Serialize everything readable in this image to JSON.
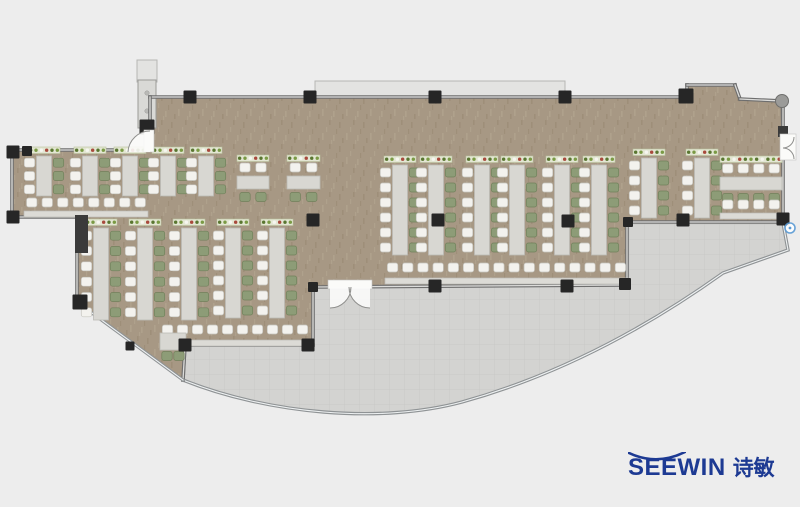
{
  "logo": {
    "latin": "SEEWIN",
    "cjk": "诗敏"
  },
  "palette": {
    "bg": "#ededed",
    "floor": "#a79884",
    "grain1": "#96876f",
    "grain2": "#b6a792",
    "terrace": "#d3d3d1",
    "terraceLine": "#c7c7c5",
    "wallDark": "#6e6e6e",
    "wallLight": "#dcdcda",
    "glass": "#8f9395",
    "glassLight": "#eef1f2",
    "column": "#262626",
    "block": "#3a3a3a",
    "table": "#d8d7d2",
    "tableBorder": "#bcbbb6",
    "chairWhite": "#f3f2ee",
    "chairWhiteBorder": "#c6c5bf",
    "chairGreen": "#8d9c77",
    "chairGreenBorder": "#71805b",
    "planter": "#e3e6d3",
    "planterBorder": "#b9c19c",
    "dotGreen": "#597630",
    "dotGreen2": "#7a9a44",
    "dotRed": "#a8493c",
    "dotWhite": "#f6f6f0",
    "counter": "#dcdbd6",
    "counterBorder": "#bdbcb7",
    "canopy": "#e3e3e1",
    "canopyBorder": "#b6b6b4",
    "shaft": "#d9d9d6",
    "shaftBorder": "#9a9a97",
    "shaftKnob": "#b9b9b6",
    "doorWhite": "#fbfbf9",
    "doorArc": "#8f8f8d",
    "markerBlue": "#5b9bd5",
    "logoBlue": "#1d3a93"
  },
  "plan": {
    "floor_outline": "150,97 687,97 687,85 735,85 740,99 781,101 783,222 627,222 627,285 313,287 313,345 185,345 183,380 77,302 77,217 12,217 12,150 150,150",
    "terrace_path": "M185,346 L313,346 L313,288 L627,286 L627,223 L783,223 L788,250 L723,273 C660,318 570,372 462,402 C380,424 268,414 183,380 Z",
    "terrace_glass": "M783,223 L788,250 L723,273 C660,318 570,372 462,402 C380,424 268,414 183,380 L185,345",
    "glass_walls": [
      [
        77,
        302,
        183,
        380
      ]
    ],
    "walls": [
      [
        150,
        97,
        687,
        97
      ],
      [
        687,
        97,
        687,
        85
      ],
      [
        687,
        85,
        735,
        85
      ],
      [
        735,
        85,
        740,
        99
      ],
      [
        740,
        99,
        781,
        101
      ],
      [
        783,
        101,
        783,
        222
      ],
      [
        627,
        222,
        783,
        222
      ],
      [
        627,
        222,
        627,
        285
      ],
      [
        313,
        287,
        627,
        285
      ],
      [
        313,
        287,
        313,
        345
      ],
      [
        185,
        345,
        313,
        345
      ],
      [
        183,
        380,
        185,
        345
      ],
      [
        77,
        302,
        77,
        217
      ],
      [
        12,
        217,
        77,
        217
      ],
      [
        12,
        150,
        12,
        217
      ],
      [
        12,
        150,
        150,
        150
      ],
      [
        150,
        97,
        150,
        150
      ]
    ],
    "canopies": [
      [
        315,
        81,
        250,
        16
      ],
      [
        137,
        60,
        20,
        22
      ]
    ],
    "shaft": {
      "x": 138,
      "y": 80,
      "w": 18,
      "h": 48
    },
    "columns": [
      [
        190,
        97
      ],
      [
        310,
        97
      ],
      [
        435,
        97
      ],
      [
        565,
        97
      ],
      [
        686,
        96,
        15
      ],
      [
        783,
        219
      ],
      [
        683,
        220
      ],
      [
        628,
        222,
        10
      ],
      [
        435,
        286
      ],
      [
        567,
        286
      ],
      [
        625,
        284,
        12
      ],
      [
        313,
        287,
        10
      ],
      [
        308,
        345
      ],
      [
        185,
        345
      ],
      [
        130,
        346,
        9
      ],
      [
        80,
        302,
        15
      ],
      [
        13,
        152
      ],
      [
        13,
        217
      ],
      [
        27,
        151,
        10
      ],
      [
        147,
        127,
        15
      ],
      [
        313,
        220
      ],
      [
        438,
        220
      ],
      [
        568,
        221
      ]
    ],
    "column_size": 13,
    "blocks": [
      [
        75,
        215,
        13,
        38
      ],
      [
        778,
        126,
        10,
        11
      ]
    ],
    "round_columns": [
      [
        782,
        101,
        6.5
      ]
    ],
    "marker": {
      "cx": 790,
      "cy": 228,
      "r": 5
    },
    "doors": [
      {
        "rect": [
          780,
          134,
          16,
          26
        ],
        "arcs": "M783,148 A11,11 0 0 0 794,137 M783,148 A11,11 0 0 1 794,159"
      },
      {
        "rect": [
          328,
          280,
          44,
          9
        ],
        "wedge": "M330,287 L351,287 A21,21 0 0 1 330,308 Z M370,287 L349,287 A21,21 0 0 0 370,308 Z",
        "arcs": "M351,287 A21,21 0 0 1 330,308 M349,287 A21,21 0 0 0 370,308"
      },
      {
        "rect": [
          144,
          130,
          10,
          22
        ],
        "wedge": "M150,152 L128,152 A22,22 0 0 1 150,131 Z",
        "arcs": "M128,152 A22,22 0 0 1 150,131"
      }
    ],
    "furniture": {
      "vrows": [
        [
          44,
          156,
          40
        ],
        [
          90,
          156,
          40
        ],
        [
          130,
          156,
          40
        ],
        [
          168,
          156,
          40
        ],
        [
          206,
          156,
          40
        ],
        [
          101,
          228,
          92
        ],
        [
          145,
          228,
          92
        ],
        [
          189,
          228,
          92
        ],
        [
          233,
          228,
          90
        ],
        [
          277,
          228,
          90
        ],
        [
          400,
          165,
          90
        ],
        [
          436,
          165,
          90
        ],
        [
          482,
          165,
          90
        ],
        [
          517,
          165,
          90
        ],
        [
          562,
          165,
          90
        ],
        [
          599,
          165,
          90
        ],
        [
          649,
          158,
          60
        ],
        [
          702,
          158,
          60
        ]
      ],
      "hrows": [
        [
          237,
          176,
          32
        ],
        [
          287,
          176,
          33
        ],
        [
          720,
          177,
          62
        ]
      ],
      "bars": [
        [
          385,
          263,
          243,
          16,
          278
        ],
        [
          160,
          325,
          150,
          10,
          340
        ],
        [
          24,
          198,
          124,
          8,
          211
        ],
        [
          720,
          200,
          62,
          4,
          213
        ]
      ],
      "small_tables": [
        [
          160,
          333,
          26,
          17
        ]
      ]
    }
  }
}
